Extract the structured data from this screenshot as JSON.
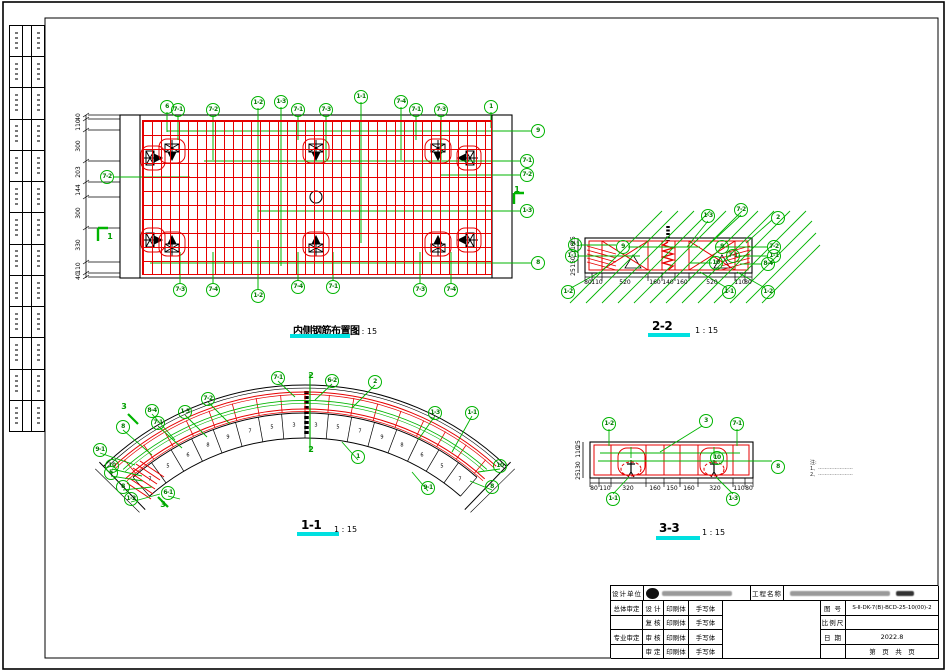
{
  "colors": {
    "red": "#e60000",
    "green": "#00b400",
    "cyan": "#00e0e0",
    "black": "#000000"
  },
  "left_strip": {
    "rows": [
      {},
      {},
      {},
      {},
      {},
      {},
      {},
      {},
      {},
      {},
      {},
      {},
      {}
    ]
  },
  "plan": {
    "title": "内侧钢筋布置图",
    "scale": "1 : 15",
    "callouts": [
      {
        "label": "6",
        "x": 167,
        "y": 107
      },
      {
        "label": "7-1",
        "x": 178,
        "y": 110
      },
      {
        "label": "7-2",
        "x": 213,
        "y": 110
      },
      {
        "label": "1-2",
        "x": 258,
        "y": 103
      },
      {
        "label": "1-3",
        "x": 281,
        "y": 102
      },
      {
        "label": "7-1",
        "x": 298,
        "y": 110
      },
      {
        "label": "7-3",
        "x": 326,
        "y": 110
      },
      {
        "label": "1-1",
        "x": 361,
        "y": 97
      },
      {
        "label": "7-4",
        "x": 401,
        "y": 102
      },
      {
        "label": "7-1",
        "x": 416,
        "y": 110
      },
      {
        "label": "7-3",
        "x": 441,
        "y": 110
      },
      {
        "label": "1",
        "x": 491,
        "y": 107
      },
      {
        "label": "9",
        "x": 538,
        "y": 131
      },
      {
        "label": "7-1",
        "x": 527,
        "y": 161
      },
      {
        "label": "7-2",
        "x": 527,
        "y": 175
      },
      {
        "label": "1-3",
        "x": 527,
        "y": 211
      },
      {
        "label": "8",
        "x": 538,
        "y": 263
      },
      {
        "label": "7-2",
        "x": 107,
        "y": 177
      },
      {
        "label": "7-3",
        "x": 180,
        "y": 290
      },
      {
        "label": "7-4",
        "x": 213,
        "y": 290
      },
      {
        "label": "1-2",
        "x": 258,
        "y": 296
      },
      {
        "label": "7-4",
        "x": 298,
        "y": 287
      },
      {
        "label": "7-1",
        "x": 333,
        "y": 287
      },
      {
        "label": "7-3",
        "x": 420,
        "y": 290
      },
      {
        "label": "7-4",
        "x": 451,
        "y": 290
      }
    ],
    "dims_left": [
      {
        "label": "40",
        "x": 79,
        "y": 117,
        "r": -90
      },
      {
        "label": "110",
        "x": 79,
        "y": 125,
        "r": -90
      },
      {
        "label": "300",
        "x": 79,
        "y": 146,
        "r": -90
      },
      {
        "label": "203",
        "x": 79,
        "y": 172,
        "r": -90
      },
      {
        "label": "144",
        "x": 79,
        "y": 190,
        "r": -90
      },
      {
        "label": "300",
        "x": 79,
        "y": 213,
        "r": -90
      },
      {
        "label": "330",
        "x": 79,
        "y": 245,
        "r": -90
      },
      {
        "label": "110",
        "x": 79,
        "y": 268,
        "r": -90
      },
      {
        "label": "40",
        "x": 79,
        "y": 276,
        "r": -90
      }
    ],
    "marks": [
      {
        "label": "1",
        "x": 110,
        "y": 237
      },
      {
        "label": "1",
        "x": 517,
        "y": 190
      }
    ]
  },
  "s22": {
    "title": "2-2",
    "scale": "1 : 15",
    "callouts": [
      {
        "label": "1-3",
        "x": 708,
        "y": 216
      },
      {
        "label": "7-2",
        "x": 741,
        "y": 210
      },
      {
        "label": "2",
        "x": 778,
        "y": 218
      },
      {
        "label": "7-1",
        "x": 575,
        "y": 245
      },
      {
        "label": "1-1",
        "x": 572,
        "y": 256
      },
      {
        "label": "9",
        "x": 623,
        "y": 247
      },
      {
        "label": "9",
        "x": 722,
        "y": 247
      },
      {
        "label": "7-1",
        "x": 733,
        "y": 256
      },
      {
        "label": "10",
        "x": 716,
        "y": 263
      },
      {
        "label": "7-2",
        "x": 774,
        "y": 247
      },
      {
        "label": "1-1",
        "x": 774,
        "y": 256
      },
      {
        "label": "8-4",
        "x": 768,
        "y": 264
      },
      {
        "label": "1-2",
        "x": 568,
        "y": 292
      },
      {
        "label": "1-1",
        "x": 729,
        "y": 292
      },
      {
        "label": "1-2",
        "x": 768,
        "y": 292
      }
    ],
    "dims_bottom": [
      {
        "label": "80",
        "x": 588,
        "y": 283
      },
      {
        "label": "110",
        "x": 597,
        "y": 283
      },
      {
        "label": "520",
        "x": 625,
        "y": 283
      },
      {
        "label": "160",
        "x": 655,
        "y": 283
      },
      {
        "label": "140",
        "x": 668,
        "y": 283
      },
      {
        "label": "160",
        "x": 682,
        "y": 283
      },
      {
        "label": "520",
        "x": 712,
        "y": 283
      },
      {
        "label": "110",
        "x": 740,
        "y": 283
      },
      {
        "label": "80",
        "x": 748,
        "y": 283
      }
    ],
    "dims_left": [
      {
        "label": "25",
        "x": 574,
        "y": 240,
        "r": -90
      },
      {
        "label": "110",
        "x": 574,
        "y": 248,
        "r": -90
      },
      {
        "label": "150",
        "x": 574,
        "y": 262,
        "r": -90
      },
      {
        "label": "25",
        "x": 574,
        "y": 272,
        "r": -90
      }
    ]
  },
  "arch": {
    "title": "1-1",
    "scale": "1 : 15",
    "callouts": [
      {
        "label": "7-1",
        "x": 278,
        "y": 378
      },
      {
        "label": "6-2",
        "x": 332,
        "y": 381
      },
      {
        "label": "2",
        "x": 375,
        "y": 382
      },
      {
        "label": "7-2",
        "x": 208,
        "y": 399
      },
      {
        "label": "1-3",
        "x": 185,
        "y": 412
      },
      {
        "label": "8-4",
        "x": 152,
        "y": 411
      },
      {
        "label": "7-1",
        "x": 158,
        "y": 423
      },
      {
        "label": "8",
        "x": 123,
        "y": 427
      },
      {
        "label": "9-1",
        "x": 100,
        "y": 450
      },
      {
        "label": "10",
        "x": 112,
        "y": 466
      },
      {
        "label": "5",
        "x": 111,
        "y": 473
      },
      {
        "label": "8",
        "x": 123,
        "y": 487
      },
      {
        "label": "1-2",
        "x": 131,
        "y": 499
      },
      {
        "label": "6-1",
        "x": 168,
        "y": 493
      },
      {
        "label": "1",
        "x": 358,
        "y": 457
      },
      {
        "label": "1-3",
        "x": 435,
        "y": 413
      },
      {
        "label": "1-1",
        "x": 472,
        "y": 413
      },
      {
        "label": "10",
        "x": 500,
        "y": 466
      },
      {
        "label": "8",
        "x": 492,
        "y": 487
      },
      {
        "label": "9-1",
        "x": 428,
        "y": 488
      }
    ],
    "segments": [
      {
        "label": "7",
        "x": 150,
        "y": 480
      },
      {
        "label": "5",
        "x": 168,
        "y": 467
      },
      {
        "label": "6",
        "x": 188,
        "y": 456
      },
      {
        "label": "8",
        "x": 208,
        "y": 446
      },
      {
        "label": "9",
        "x": 228,
        "y": 438
      },
      {
        "label": "7",
        "x": 250,
        "y": 432
      },
      {
        "label": "5",
        "x": 272,
        "y": 428
      },
      {
        "label": "3",
        "x": 294,
        "y": 426
      },
      {
        "label": "3",
        "x": 316,
        "y": 426
      },
      {
        "label": "5",
        "x": 338,
        "y": 428
      },
      {
        "label": "7",
        "x": 360,
        "y": 432
      },
      {
        "label": "9",
        "x": 382,
        "y": 438
      },
      {
        "label": "8",
        "x": 402,
        "y": 446
      },
      {
        "label": "6",
        "x": 422,
        "y": 456
      },
      {
        "label": "5",
        "x": 442,
        "y": 467
      },
      {
        "label": "7",
        "x": 460,
        "y": 480
      }
    ],
    "marks": [
      {
        "label": "2",
        "x": 311,
        "y": 376
      },
      {
        "label": "2",
        "x": 311,
        "y": 450
      },
      {
        "label": "3",
        "x": 124,
        "y": 407
      },
      {
        "label": "3",
        "x": 163,
        "y": 505
      }
    ]
  },
  "s33": {
    "title": "3-3",
    "scale": "1 : 15",
    "callouts": [
      {
        "label": "1-2",
        "x": 609,
        "y": 424
      },
      {
        "label": "3",
        "x": 706,
        "y": 421
      },
      {
        "label": "7-1",
        "x": 737,
        "y": 424
      },
      {
        "label": "10",
        "x": 717,
        "y": 458
      },
      {
        "label": "8",
        "x": 778,
        "y": 467
      },
      {
        "label": "1-1",
        "x": 613,
        "y": 499
      },
      {
        "label": "1-3",
        "x": 733,
        "y": 499
      }
    ],
    "dims_bottom": [
      {
        "label": "80",
        "x": 594,
        "y": 489
      },
      {
        "label": "110",
        "x": 605,
        "y": 489
      },
      {
        "label": "320",
        "x": 628,
        "y": 489
      },
      {
        "label": "160",
        "x": 655,
        "y": 489
      },
      {
        "label": "150",
        "x": 672,
        "y": 489
      },
      {
        "label": "160",
        "x": 689,
        "y": 489
      },
      {
        "label": "320",
        "x": 715,
        "y": 489
      },
      {
        "label": "110",
        "x": 739,
        "y": 489
      },
      {
        "label": "80",
        "x": 749,
        "y": 489
      }
    ],
    "dims_left": [
      {
        "label": "25",
        "x": 579,
        "y": 444,
        "r": -90
      },
      {
        "label": "110",
        "x": 579,
        "y": 452,
        "r": -90
      },
      {
        "label": "130",
        "x": 579,
        "y": 467,
        "r": -90
      },
      {
        "label": "25",
        "x": 579,
        "y": 476,
        "r": -90
      }
    ],
    "note": {
      "head": "注:",
      "lines": [
        "1、⋯⋯⋯⋯⋯⋯⋯",
        "2、⋯⋯⋯⋯⋯⋯⋯"
      ]
    }
  },
  "titleblock": {
    "design_unit_label": "设计单位",
    "project_label": "工程名称",
    "rows": [
      {
        "c1": "总体审定",
        "c2": "设 计",
        "c3": "印刷体",
        "c4": "手写体"
      },
      {
        "c1": "",
        "c2": "复 核",
        "c3": "印刷体",
        "c4": "手写体"
      },
      {
        "c1": "专业审定",
        "c2": "审 核",
        "c3": "印刷体",
        "c4": "手写体"
      },
      {
        "c1": "",
        "c2": "审 定",
        "c3": "印刷体",
        "c4": "手写体"
      }
    ],
    "fig_label": "图 号",
    "fig_value": "S-Ⅱ-DK-7(B)-BCD-25-10(00)-2",
    "scale_label": "比例尺",
    "scale_value": "",
    "date_label": "日 期",
    "date_value": "2022.8",
    "pages": "第　页　共　页"
  }
}
